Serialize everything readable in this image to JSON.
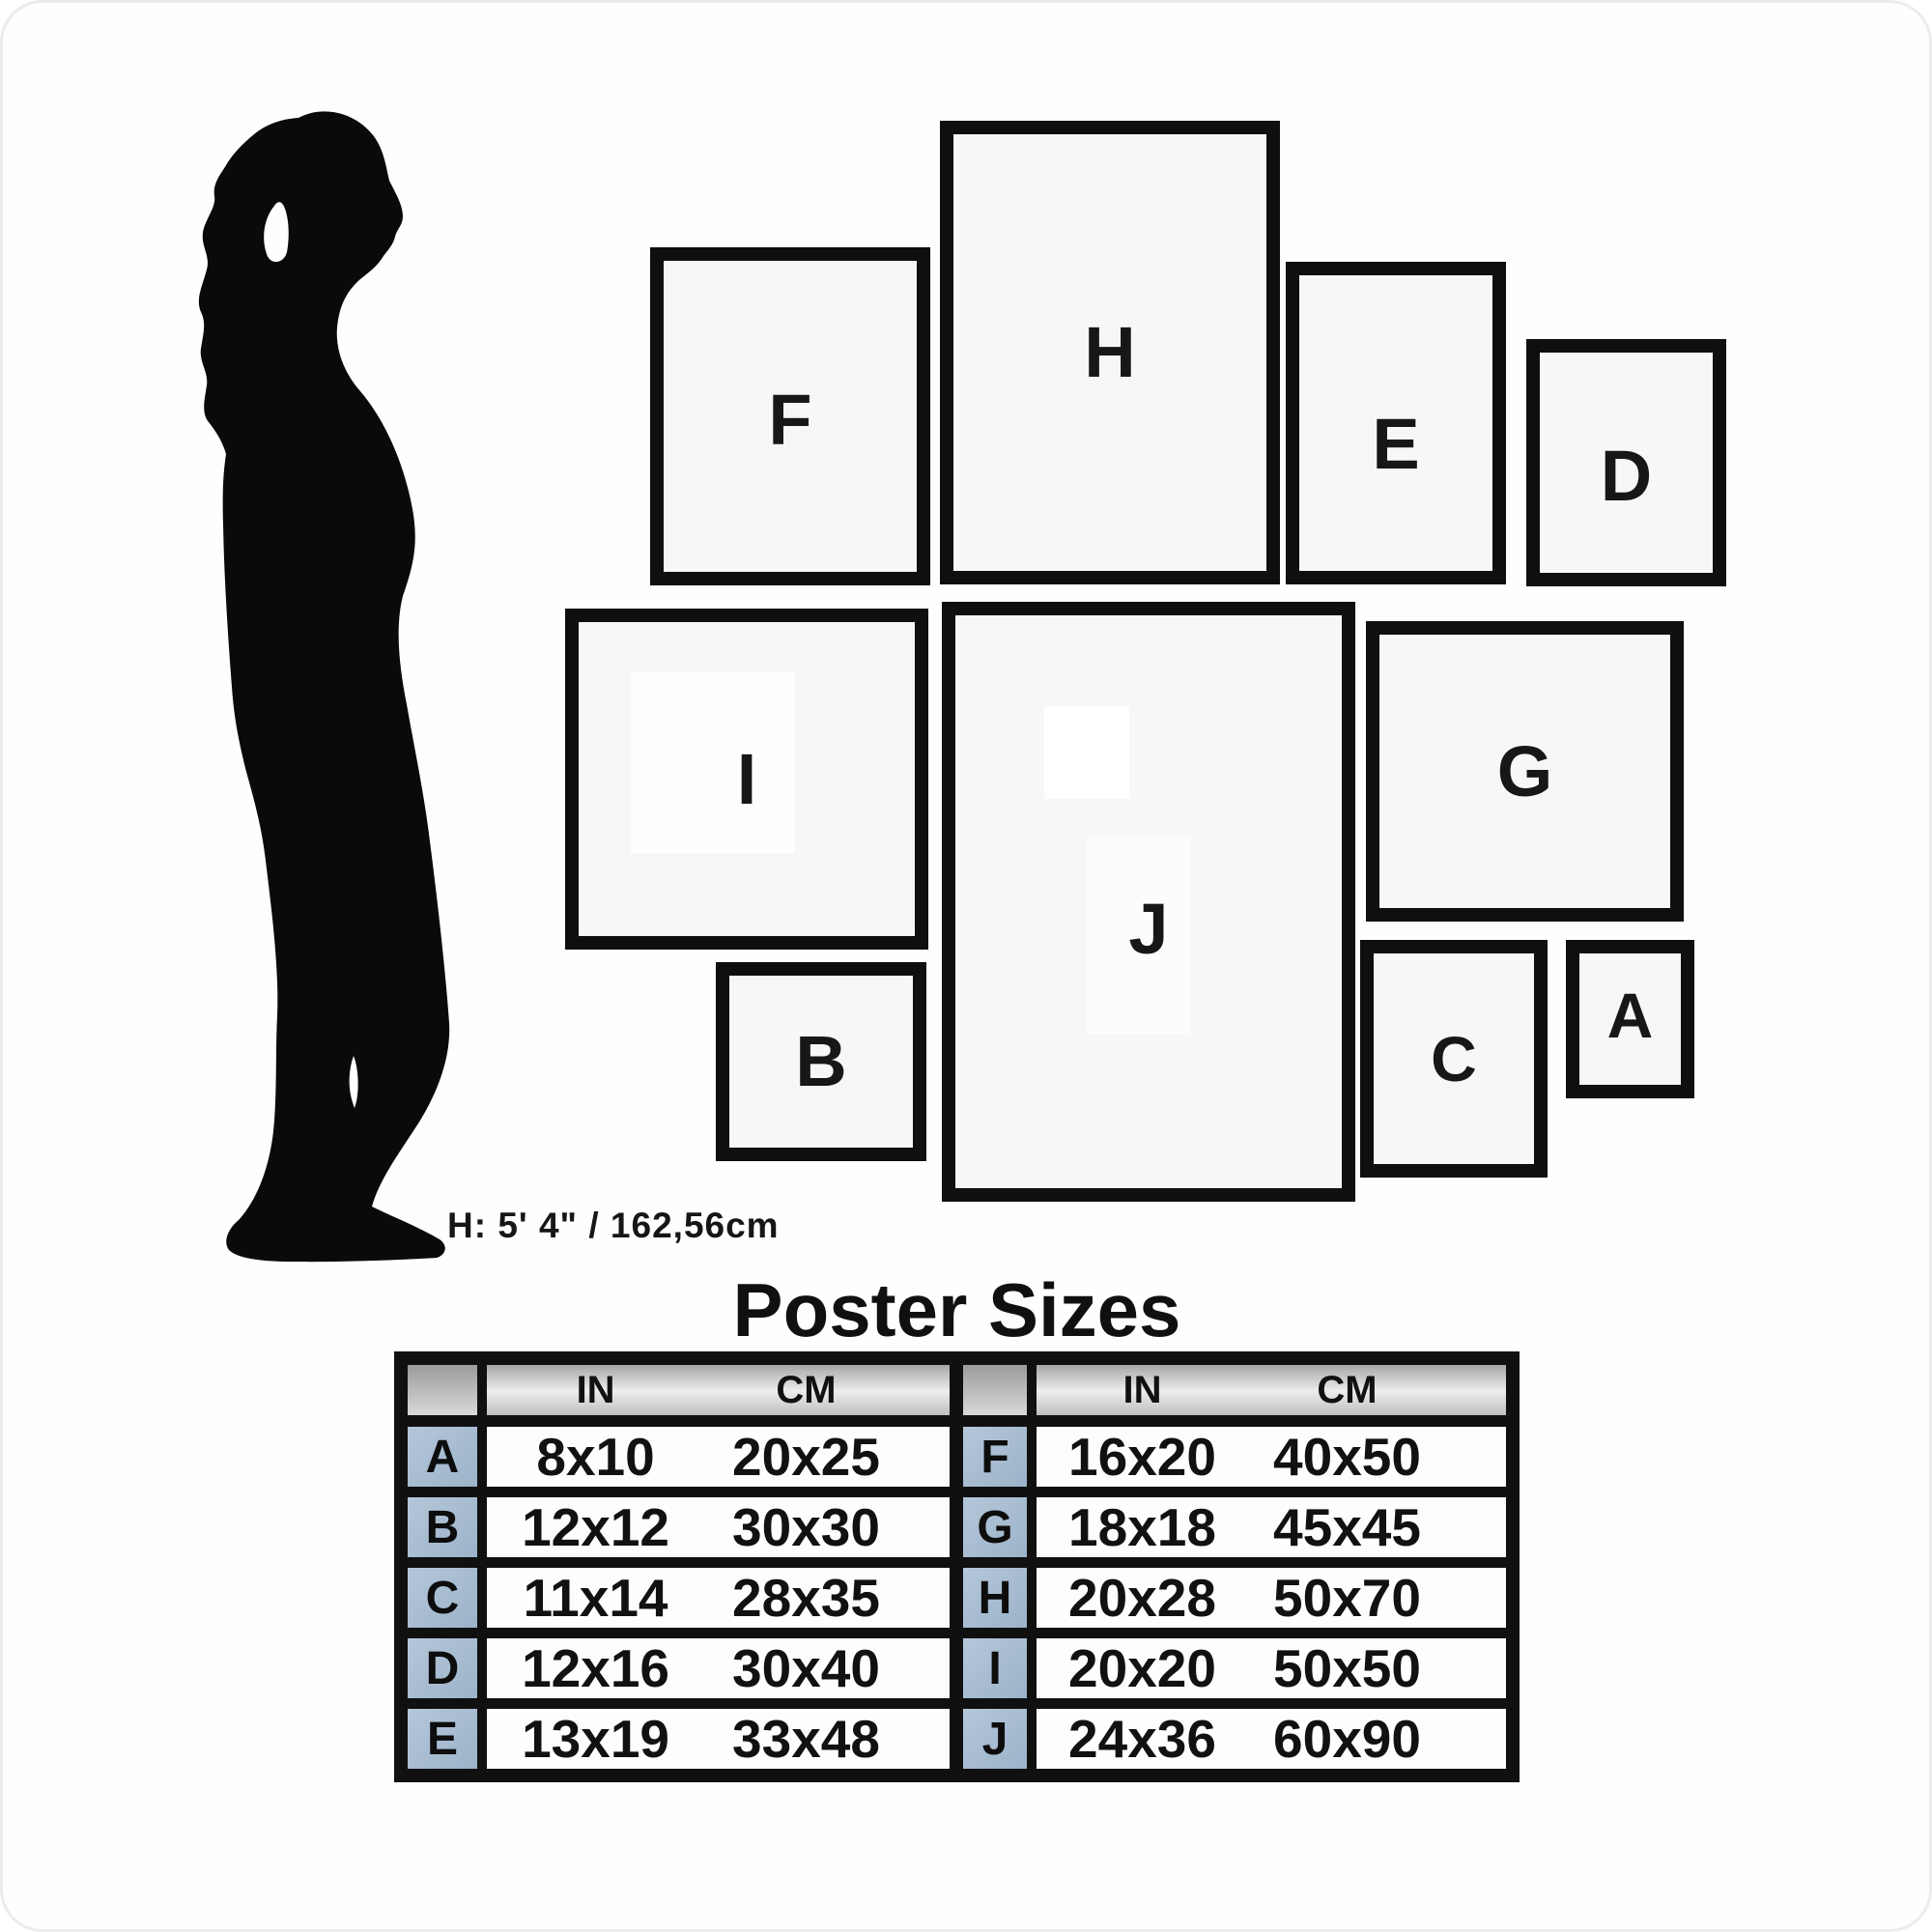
{
  "silhouette": {
    "icon": "woman-silhouette",
    "height_label": "H: 5' 4\" / 162,56cm"
  },
  "frames": {
    "A": {
      "label": "A"
    },
    "B": {
      "label": "B"
    },
    "C": {
      "label": "C"
    },
    "D": {
      "label": "D"
    },
    "E": {
      "label": "E"
    },
    "F": {
      "label": "F"
    },
    "G": {
      "label": "G"
    },
    "H": {
      "label": "H"
    },
    "I": {
      "label": "I"
    },
    "J": {
      "label": "J"
    }
  },
  "table": {
    "title": "Poster Sizes",
    "headers": {
      "in": "IN",
      "cm": "CM"
    },
    "left_rows": [
      {
        "letter": "A",
        "in": "8x10",
        "cm": "20x25"
      },
      {
        "letter": "B",
        "in": "12x12",
        "cm": "30x30"
      },
      {
        "letter": "C",
        "in": "11x14",
        "cm": "28x35"
      },
      {
        "letter": "D",
        "in": "12x16",
        "cm": "30x40"
      },
      {
        "letter": "E",
        "in": "13x19",
        "cm": "33x48"
      }
    ],
    "right_rows": [
      {
        "letter": "F",
        "in": "16x20",
        "cm": "40x50"
      },
      {
        "letter": "G",
        "in": "18x18",
        "cm": "45x45"
      },
      {
        "letter": "H",
        "in": "20x28",
        "cm": "50x70"
      },
      {
        "letter": "I",
        "in": "20x20",
        "cm": "50x50"
      },
      {
        "letter": "J",
        "in": "24x36",
        "cm": "60x90"
      }
    ]
  },
  "colors": {
    "ink": "#101010",
    "letter_cell_blue": "#a6bcd2",
    "frame_interior": "#f8f7f5"
  }
}
